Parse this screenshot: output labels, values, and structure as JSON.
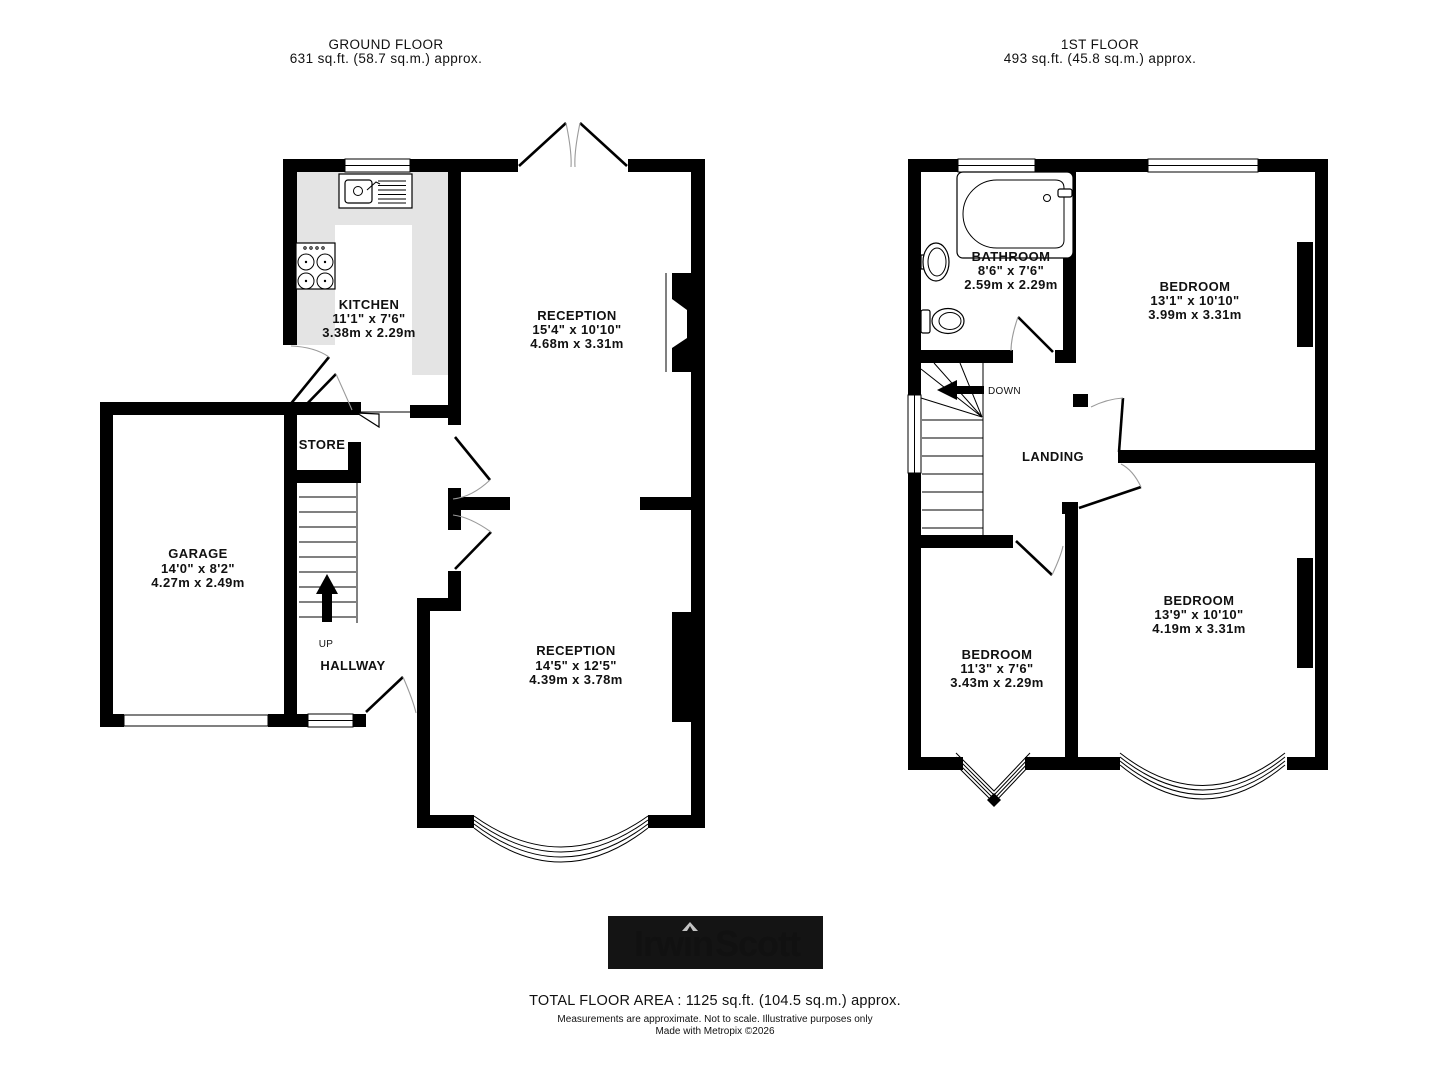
{
  "colors": {
    "wall": "#000000",
    "counter": "#e4e4e4",
    "arc": "#9a9a9a",
    "logo_bg": "#141414",
    "logo_irwin": "#c3c3c3",
    "logo_scott": "#74b530"
  },
  "ground": {
    "title": "GROUND FLOOR",
    "area": "631 sq.ft. (58.7 sq.m.) approx.",
    "kitchen": {
      "name": "KITCHEN",
      "ft": "11'1\"  x 7'6\"",
      "m": "3.38m  x 2.29m"
    },
    "reception1": {
      "name": "RECEPTION",
      "ft": "15'4\"  x 10'10\"",
      "m": "4.68m  x 3.31m"
    },
    "store": {
      "name": "STORE"
    },
    "garage": {
      "name": "GARAGE",
      "ft": "14'0\"  x 8'2\"",
      "m": "4.27m  x 2.49m"
    },
    "hallway": {
      "name": "HALLWAY"
    },
    "stair": "UP",
    "reception2": {
      "name": "RECEPTION",
      "ft": "14'5\"  x 12'5\"",
      "m": "4.39m  x 3.78m"
    }
  },
  "first": {
    "title": "1ST FLOOR",
    "area": "493 sq.ft. (45.8 sq.m.) approx.",
    "bathroom": {
      "name": "BATHROOM",
      "ft": "8'6\"  x 7'6\"",
      "m": "2.59m  x 2.29m"
    },
    "bedroom1": {
      "name": "BEDROOM",
      "ft": "13'1\"  x 10'10\"",
      "m": "3.99m  x 3.31m"
    },
    "landing": {
      "name": "LANDING"
    },
    "stair": "DOWN",
    "bedroom2": {
      "name": "BEDROOM",
      "ft": "11'3\"  x 7'6\"",
      "m": "3.43m  x 2.29m"
    },
    "bedroom3": {
      "name": "BEDROOM",
      "ft": "13'9\"  x 10'10\"",
      "m": "4.19m  x 3.31m"
    }
  },
  "logo": {
    "irwin": "Irwin",
    "scott": "Scott"
  },
  "footer": {
    "total": "TOTAL FLOOR AREA : 1125 sq.ft. (104.5 sq.m.) approx.",
    "disclaimer": "Measurements are approximate.  Not to scale.  Illustrative purposes only",
    "credit": "Made with Metropix ©2026"
  }
}
